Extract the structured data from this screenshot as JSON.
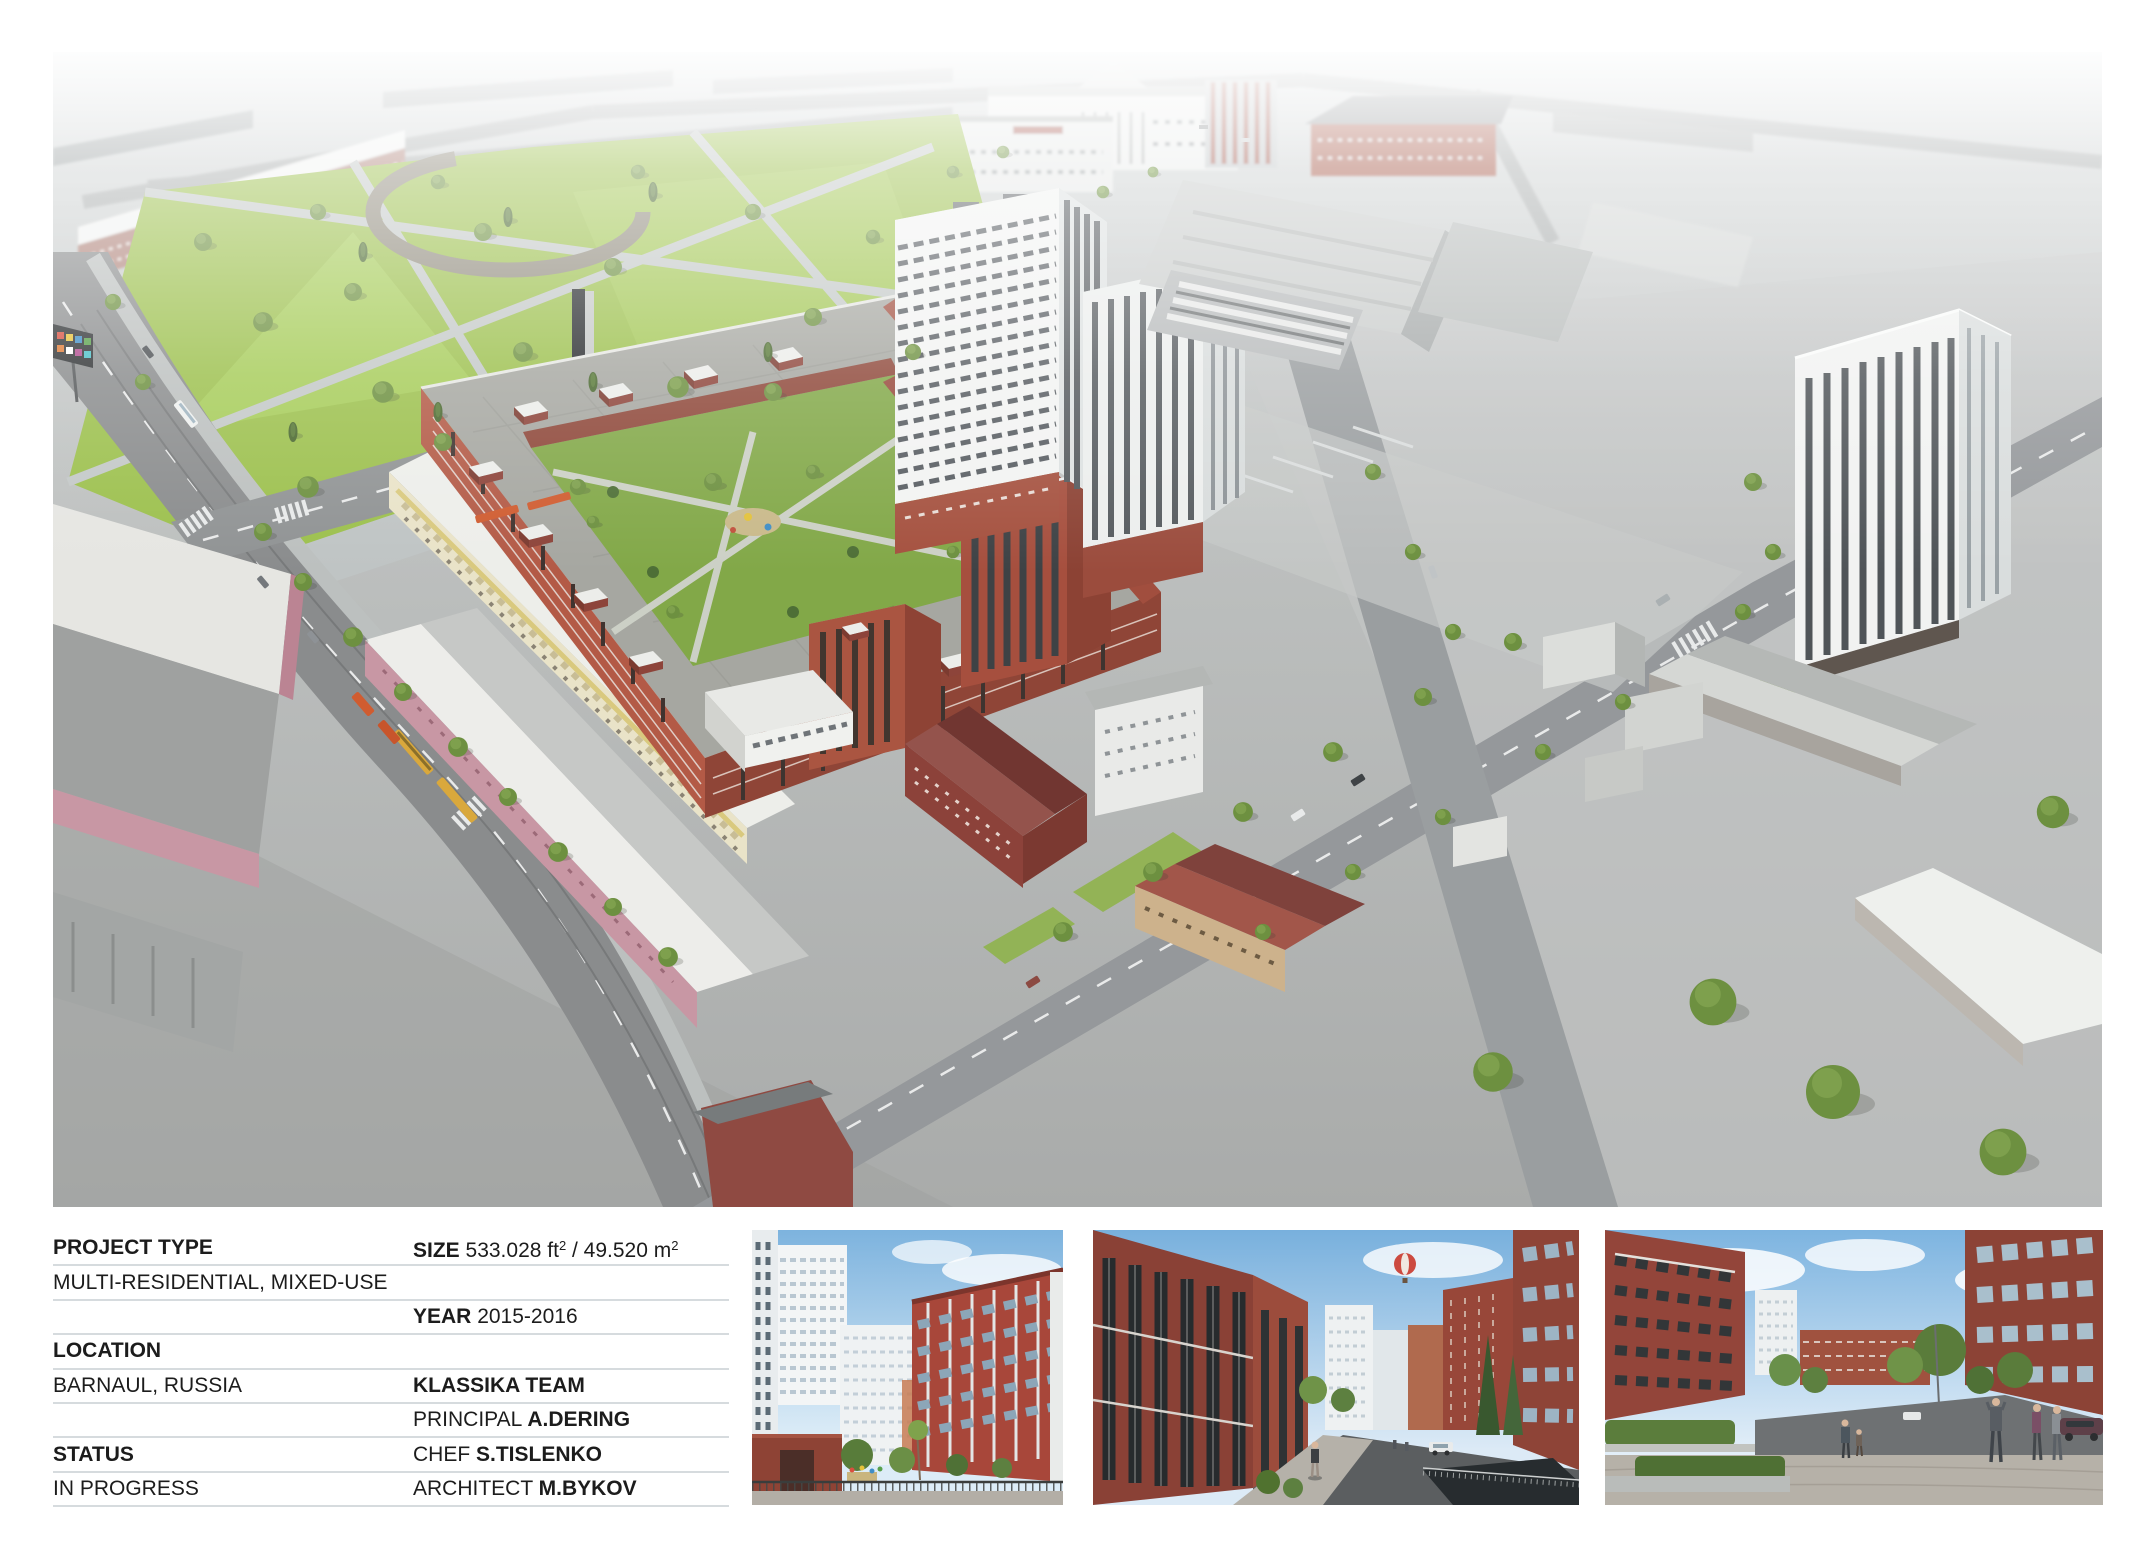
{
  "palette": {
    "page_bg": "#ffffff",
    "text": "#1c1c1c",
    "divider": "#d6dbde",
    "brick_red": "#a24e3d",
    "lawn_green": "#9cc04d",
    "haze_sky_gray": "#ccd3d6",
    "thumb_sky_blue": "#85b8e3"
  },
  "renders": {
    "main": {
      "label": "aerial-masterplan-render"
    },
    "thumb1": {
      "label": "courtyard-render"
    },
    "thumb2": {
      "label": "street-render-with-balloon"
    },
    "thumb3": {
      "label": "plaza-render-with-people"
    }
  },
  "info_table": {
    "rows": [
      {
        "left": [
          {
            "t": "PROJECT TYPE",
            "b": true
          }
        ],
        "right": [
          {
            "t": "SIZE",
            "b": true
          },
          {
            "t": " 533.028 ft"
          },
          {
            "t": "2",
            "sup": true
          },
          {
            "t": " / 49.520 m"
          },
          {
            "t": "2",
            "sup": true
          }
        ]
      },
      {
        "left": [
          {
            "t": "MULTI-RESIDENTIAL, MIXED-USE"
          }
        ],
        "right": []
      },
      {
        "left": [],
        "right": [
          {
            "t": "YEAR",
            "b": true
          },
          {
            "t": " 2015-2016"
          }
        ]
      },
      {
        "left": [
          {
            "t": "LOCATION",
            "b": true
          }
        ],
        "right": []
      },
      {
        "left": [
          {
            "t": "BARNAUL, RUSSIA"
          }
        ],
        "right": [
          {
            "t": "KLASSIKA TEAM",
            "b": true
          }
        ]
      },
      {
        "left": [],
        "right": [
          {
            "t": "PRINCIPAL "
          },
          {
            "t": "A.DERING",
            "b": true
          }
        ]
      },
      {
        "left": [
          {
            "t": "STATUS",
            "b": true
          }
        ],
        "right": [
          {
            "t": "CHEF "
          },
          {
            "t": "S.TISLENKO",
            "b": true
          }
        ]
      },
      {
        "left": [
          {
            "t": "IN PROGRESS"
          }
        ],
        "right": [
          {
            "t": "ARCHITECT "
          },
          {
            "t": "M.BYKOV",
            "b": true
          }
        ]
      }
    ]
  }
}
